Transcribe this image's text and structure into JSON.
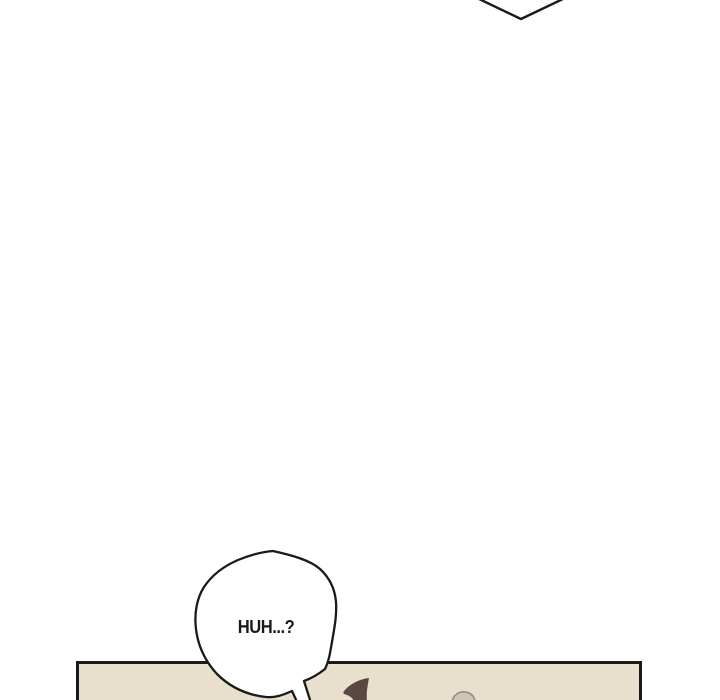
{
  "page": {
    "type": "webtoon-comic-strip",
    "background_color": "#ffffff",
    "ink_color": "#1a1a1a"
  },
  "previous_bubble_tip": {
    "shape": "speech-bubble-bottom-tip",
    "fill": "#ffffff",
    "stroke": "#1a1a1a"
  },
  "speech_bubble": {
    "text": "HUH...?",
    "fill": "#ffffff",
    "stroke": "#1a1a1a"
  },
  "panel": {
    "background_color": "#e8dfcd",
    "border_color": "#1a1a1a",
    "hair_lock_color": "#5a4741",
    "gray_object_fill": "#ccc5b8",
    "gray_object_stroke": "#938c80"
  }
}
